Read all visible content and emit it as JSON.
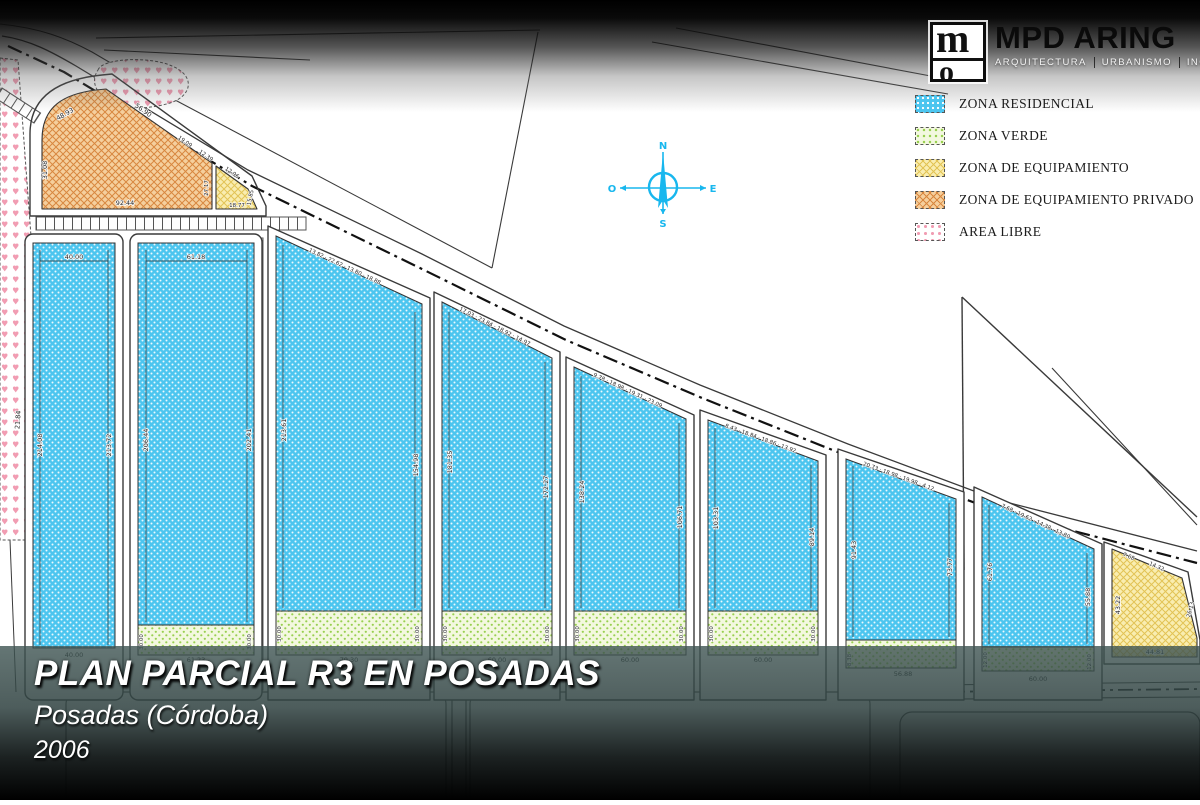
{
  "branding": {
    "logo_title": "MPD ARING",
    "logo_sub": [
      "ARQUITECTURA",
      "URBANISMO",
      "INGENIERÍA"
    ],
    "monogram_top": "m",
    "monogram_bottom": "o"
  },
  "legend": {
    "items": [
      {
        "label": "ZONA RESIDENCIAL",
        "color": "#4cc5ef",
        "pattern": "dot-grid"
      },
      {
        "label": "ZONA VERDE",
        "color": "#98d050",
        "pattern": "dots"
      },
      {
        "label": "ZONA DE EQUIPAMIENTO",
        "color": "#f9edb0",
        "pattern": "crosshatch"
      },
      {
        "label": "ZONA DE EQUIPAMIENTO PRIVADO",
        "color": "#f5cf9d",
        "pattern": "crosshatch"
      },
      {
        "label": "AREA LIBRE",
        "color": "#f19cb2",
        "pattern": "hearts"
      }
    ]
  },
  "title_block": {
    "title": "PLAN PARCIAL R3 EN POSADAS",
    "subtitle": "Posadas (Córdoba)",
    "year": "2006"
  },
  "compass": {
    "n": "N",
    "s": "S",
    "e": "E",
    "o": "O"
  },
  "colors": {
    "residencial": "#4cc5ef",
    "verde": "#98d050",
    "equipamiento": "#f9edb0",
    "equipamiento_privado": "#f5cf9d",
    "area_libre": "#f19cb2",
    "compass": "#18b7ee",
    "line": "#3a3a3a"
  },
  "plan": {
    "blocks": [
      {
        "top": "40.00",
        "segs": "",
        "left": "214.08",
        "right": "213.72",
        "bottom": "40.00",
        "g1": "",
        "g2": ""
      },
      {
        "top": "61.18",
        "segs": "",
        "left": "206.44",
        "right": "202.41",
        "bottom": "61.23",
        "g1": "30.00",
        "g2": "30.00"
      },
      {
        "top": "",
        "segs": "13.82 · 22.62 · 13.80 · 18.88",
        "left": "213.61",
        "right": "154.98",
        "bottom": "79.30",
        "g1": "30.00",
        "g2": "30.00"
      },
      {
        "top": "",
        "segs": "17.03 · 23.84 · 18.92 · 14.97",
        "left": "181.35",
        "right": "172.27",
        "bottom": "60.00",
        "g1": "30.00",
        "g2": "30.00"
      },
      {
        "top": "",
        "segs": "9.78 · 18.98 · 19.31 · 23.09",
        "left": "138.24",
        "right": "106.71",
        "bottom": "60.00",
        "g1": "30.00",
        "g2": "30.00"
      },
      {
        "top": "",
        "segs": "8.43 · 18.84 · 18.86 · 13.92",
        "left": "103.31",
        "right": "89.14",
        "bottom": "60.00",
        "g1": "30.00",
        "g2": "30.00"
      },
      {
        "top": "",
        "segs": "20.73 · 18.98 · 19.98 · 4.12",
        "left": "91.43",
        "right": "73.77",
        "bottom": "56.88",
        "g1": "8.38",
        "g2": ""
      },
      {
        "top": "",
        "segs": "7.68 · 19.62 · 14.38 · 13.80",
        "left": "61.76",
        "right": "55.88",
        "bottom": "60.00",
        "g1": "12.00",
        "g2": "12.00"
      }
    ],
    "equip_privado": {
      "top_left": "48.93",
      "top": "56.90",
      "top2": "19.09",
      "top3": "12.39",
      "left": "31.08",
      "bottom": "92.44",
      "divider": "27.17"
    },
    "equip_small": {
      "slant": "12.96",
      "bottom": "18.77",
      "right": "15.85"
    },
    "equip_right": {
      "top_small": "7.68",
      "top": "14.32",
      "left": "43.22",
      "right": "26.13",
      "bottom": "44.81"
    },
    "misc": {
      "strip_label": "21.84"
    }
  }
}
